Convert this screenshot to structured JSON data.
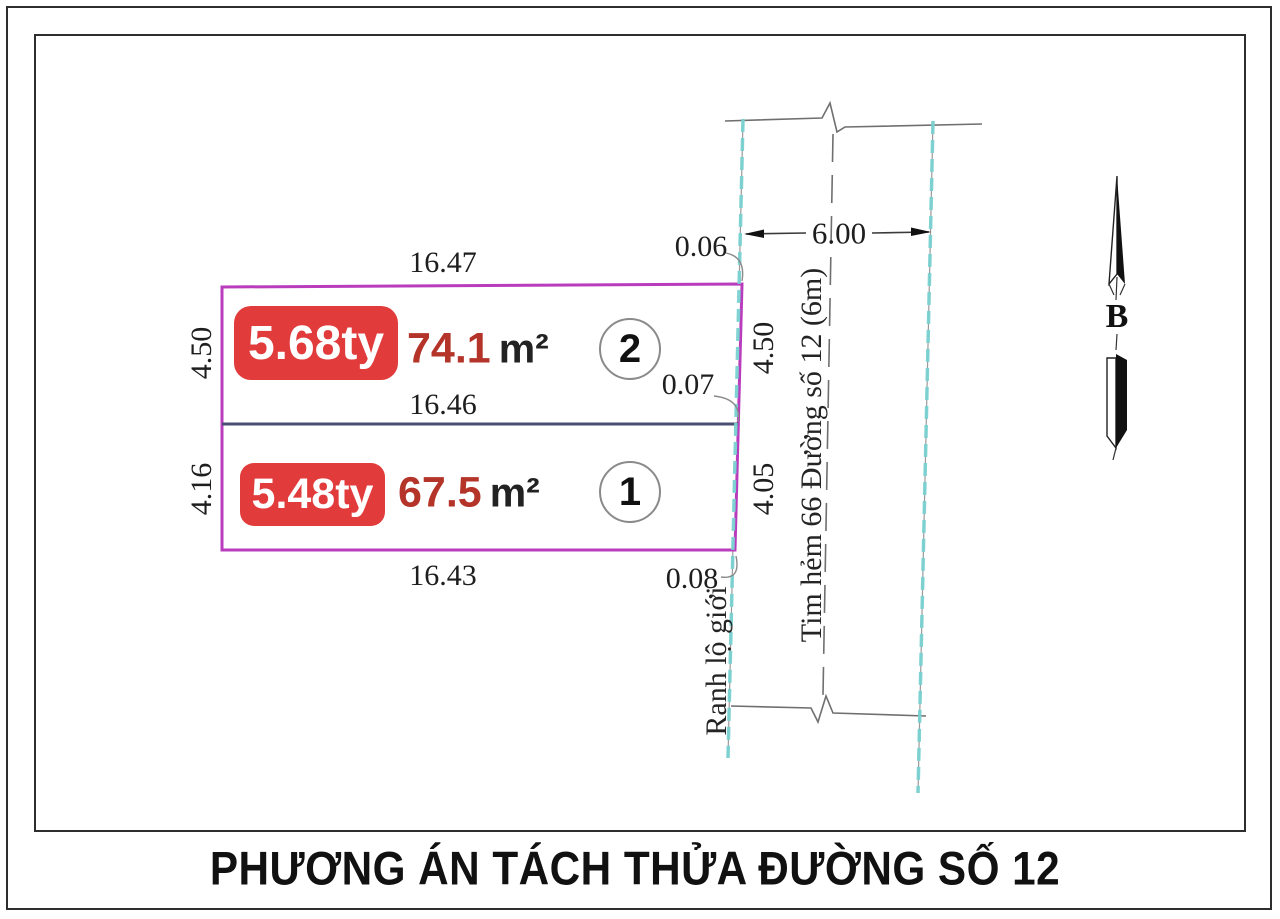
{
  "title": "PHƯƠNG ÁN TÁCH THỬA ĐƯỜNG SỐ 12",
  "north": {
    "label": "B"
  },
  "road": {
    "width_dim": "6.00",
    "centerline_label": "Tim hẻm 66 Đường số 12 (6m)",
    "boundary_label": "Ranh lộ giới"
  },
  "dimensions": {
    "top": "16.47",
    "middle": "16.46",
    "bottom": "16.43",
    "left_top": "4.50",
    "left_bottom": "4.16",
    "right_top": "4.50",
    "right_bottom": "4.05",
    "offset_top": "0.06",
    "offset_middle": "0.07",
    "offset_bottom": "0.08"
  },
  "parcels": [
    {
      "number": "2",
      "price": "5.68ty",
      "area": "74.1",
      "area_unit": "m²"
    },
    {
      "number": "1",
      "price": "5.48ty",
      "area": "67.5",
      "area_unit": "m²"
    }
  ],
  "colors": {
    "parcel_outline": "#b93cbd",
    "divider": "#4b4f73",
    "road_edge": "#79d1d1",
    "badge_bg": "#e23b3b",
    "badge_text": "#ffffff",
    "area_red": "#b5342a",
    "ink": "#1d1d1d"
  }
}
